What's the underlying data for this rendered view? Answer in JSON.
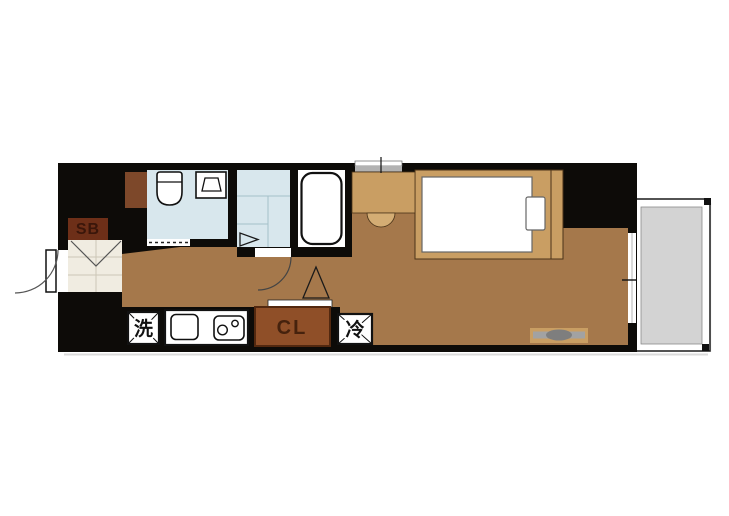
{
  "floor_plan": {
    "labels": {
      "shoe_box": "SB",
      "washer": "洗",
      "closet": "CL",
      "refrigerator": "冷"
    },
    "colors": {
      "wall": "#0d0b08",
      "floor": "#a5784b",
      "wet_room": "#d8e7ed",
      "genkan": "#f0ece1",
      "furniture_tan": "#c99e63",
      "chair_tan": "#d4ad74",
      "closet_brown": "#8f4f28",
      "closet_border": "#52280f",
      "closet_text": "#46220d",
      "shoe_box_brown": "#6d2f18",
      "pipe_space_brown": "#7d482a",
      "balcony_gray": "#d3d3d3",
      "window_gray": "#b2b2b2",
      "appliance_white": "#ffffff"
    }
  }
}
